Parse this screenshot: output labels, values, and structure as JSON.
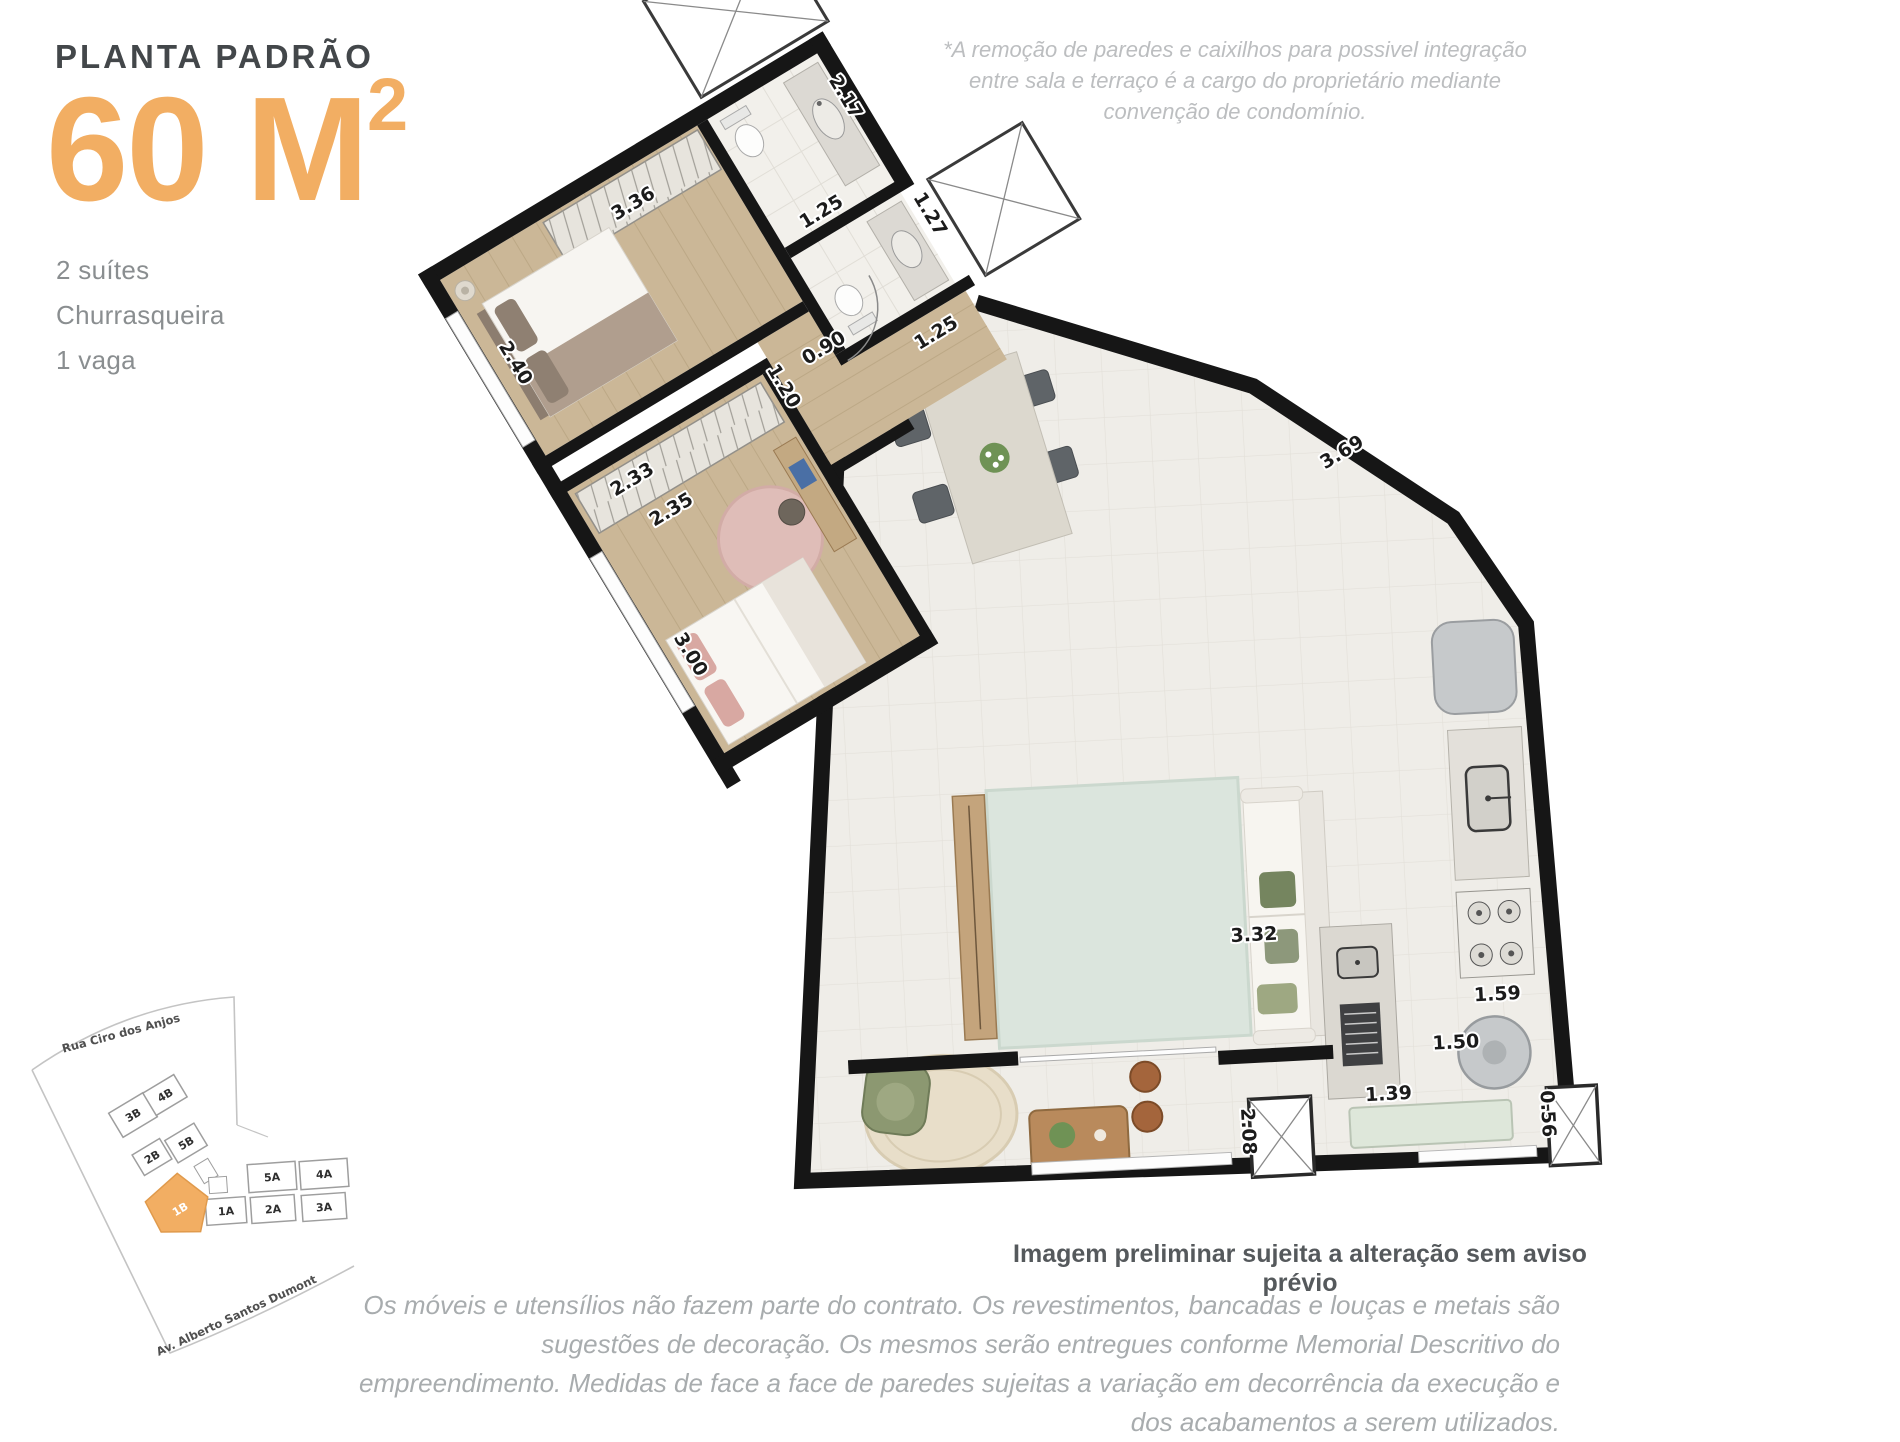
{
  "header": {
    "kicker": "PLANTA PADRÃO",
    "area_value": "60 M",
    "area_sup": "2",
    "features": [
      "2 suítes",
      "Churrasqueira",
      "1 vaga"
    ]
  },
  "disclaimer_top": "*A remoção de paredes e caixilhos para possivel integração entre sala e terraço é a cargo do proprietário mediante convenção de condomínio.",
  "plan": {
    "note_bold": "Imagem preliminar sujeita a alteração sem aviso prévio",
    "measurements": [
      "3.36",
      "2.17",
      "1.25",
      "1.27",
      "0.90",
      "1.25",
      "1.20",
      "2.40",
      "2.33",
      "2.35",
      "3.00",
      "3.69",
      "3.32",
      "1.59",
      "1.50",
      "1.39",
      "0.56",
      "2.08"
    ],
    "colors": {
      "accent": "#F2AE63",
      "wall": "#161616",
      "wood_floor": "#CBB797",
      "tile_floor": "#EFEDE8",
      "bath_floor": "#F2F0EB",
      "rug_living": "#DBE5DD",
      "rug_suite2": "#DFBDB8",
      "rug_terrace": "#E8DEC9"
    }
  },
  "site_map": {
    "streets": [
      "Rua Ciro dos Anjos",
      "Av. Alberto Santos Dumont"
    ],
    "units": [
      "3B",
      "4B",
      "2B",
      "5B",
      "5A",
      "4A",
      "1A",
      "2A",
      "3A"
    ],
    "highlighted_unit": "1B"
  },
  "disclaimer_bottom": "Os móveis e utensílios não fazem parte do contrato. Os revestimentos, bancadas e louças e metais são sugestões de decoração. Os mesmos serão entregues conforme Memorial Descritivo do empreendimento. Medidas de face a face de paredes sujeitas a variação em decorrência da execução e dos acabamentos a serem utilizados."
}
